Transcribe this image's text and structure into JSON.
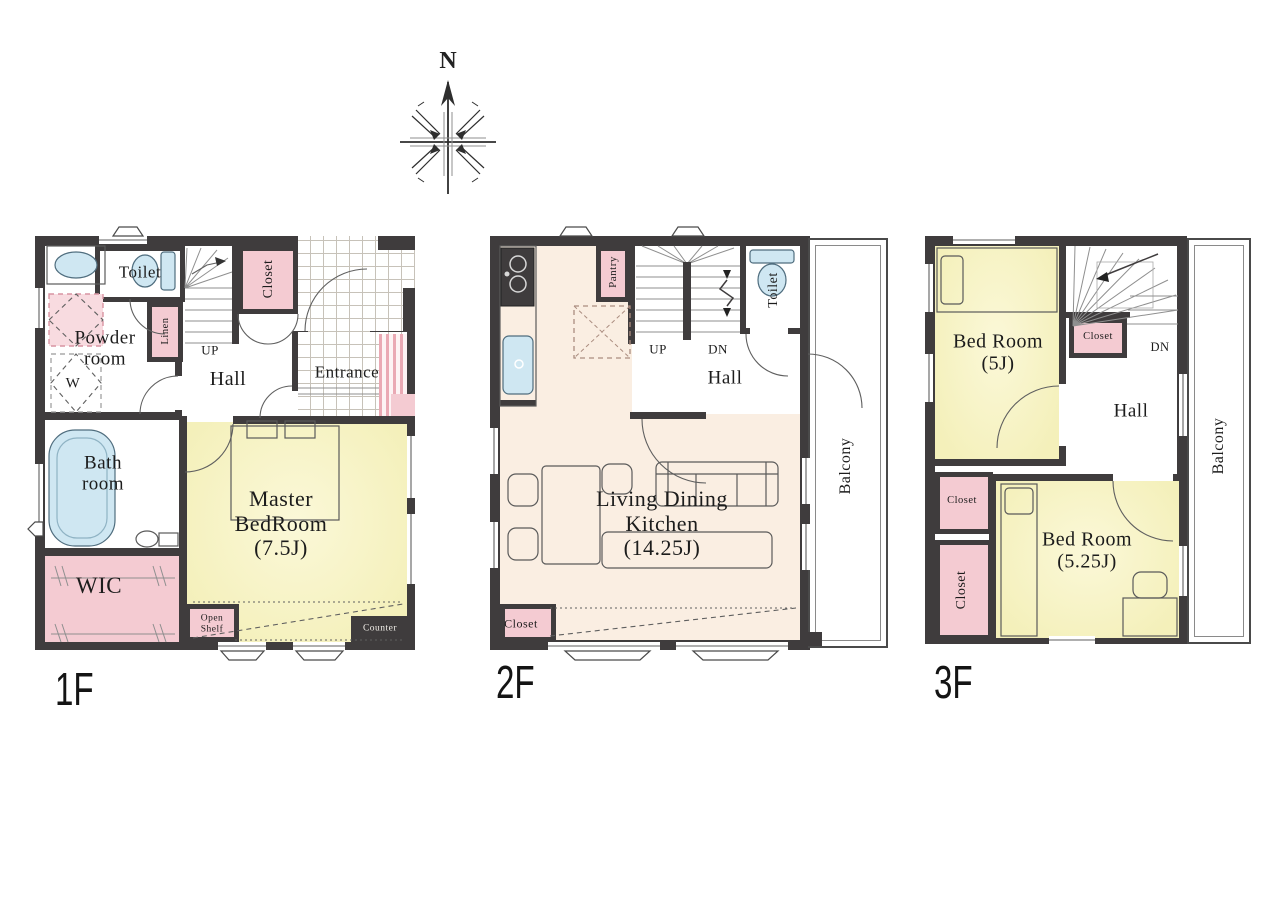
{
  "palette": {
    "wall": "#3f3c3d",
    "room_yellow": "#f6f2c2",
    "room_cream": "#faeee2",
    "closet_pink": "#f4cbd2",
    "fixture_blue": "#cfe7f2"
  },
  "compass": {
    "north": "N"
  },
  "floors": {
    "f1": {
      "label": "1F",
      "toilet": "Toilet",
      "powder": "Powder\nroom",
      "washer": "W",
      "linen": "Linen",
      "up": "UP",
      "hall": "Hall",
      "closet": "Closet",
      "entrance": "Entrance",
      "bath": "Bath\nroom",
      "wic": "WIC",
      "master": "Master\nBedRoom\n(7.5J)",
      "open_shelf": "Open\nShelf",
      "counter": "Counter"
    },
    "f2": {
      "label": "2F",
      "pantry": "Pantry",
      "up": "UP",
      "dn": "DN",
      "toilet": "Toilet",
      "hall": "Hall",
      "ldk": "Living Dining\nKitchen\n(14.25J)",
      "closet": "Closet",
      "balcony": "Balcony"
    },
    "f3": {
      "label": "3F",
      "bedroom1": "Bed Room\n(5J)",
      "closet_upper": "Closet",
      "dn": "DN",
      "hall": "Hall",
      "closet_mid": "Closet",
      "closet_lower": "Closet",
      "bedroom2": "Bed Room\n(5.25J)",
      "balcony": "Balcony"
    }
  }
}
